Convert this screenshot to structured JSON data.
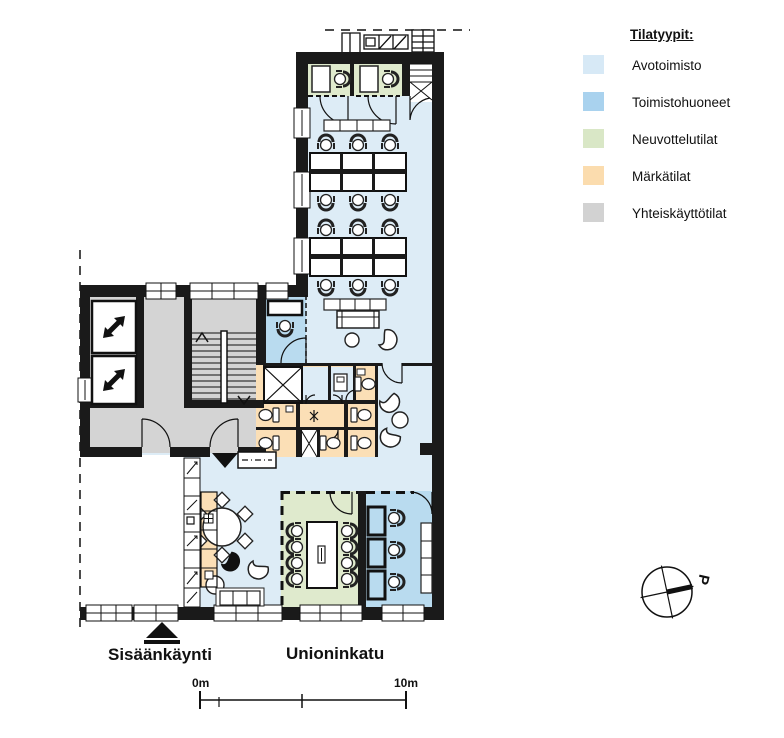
{
  "legend": {
    "title": "Tilatyypit:",
    "items": [
      {
        "label": "Avotoimisto",
        "color": "#d7e9f6"
      },
      {
        "label": "Toimistohuoneet",
        "color": "#a9d2ee"
      },
      {
        "label": "Neuvottelutilat",
        "color": "#d9e7c6"
      },
      {
        "label": "Märkätilat",
        "color": "#fbdcae"
      },
      {
        "label": "Yhteiskäyttötilat",
        "color": "#d2d2d2"
      }
    ]
  },
  "labels": {
    "entrance": "Sisäänkäynti",
    "street": "Unioninkatu"
  },
  "scale_bar": {
    "start": "0m",
    "end": "10m"
  },
  "compass": {
    "north_label": "P"
  },
  "plan_colors": {
    "open_office": "#ddecf6",
    "office_rooms": "#b9dbef",
    "meeting_rooms": "#dfeacd",
    "wet_rooms": "#fbdfb6",
    "shared_spaces": "#d4d4d4",
    "wall": "#1a1a1a"
  }
}
